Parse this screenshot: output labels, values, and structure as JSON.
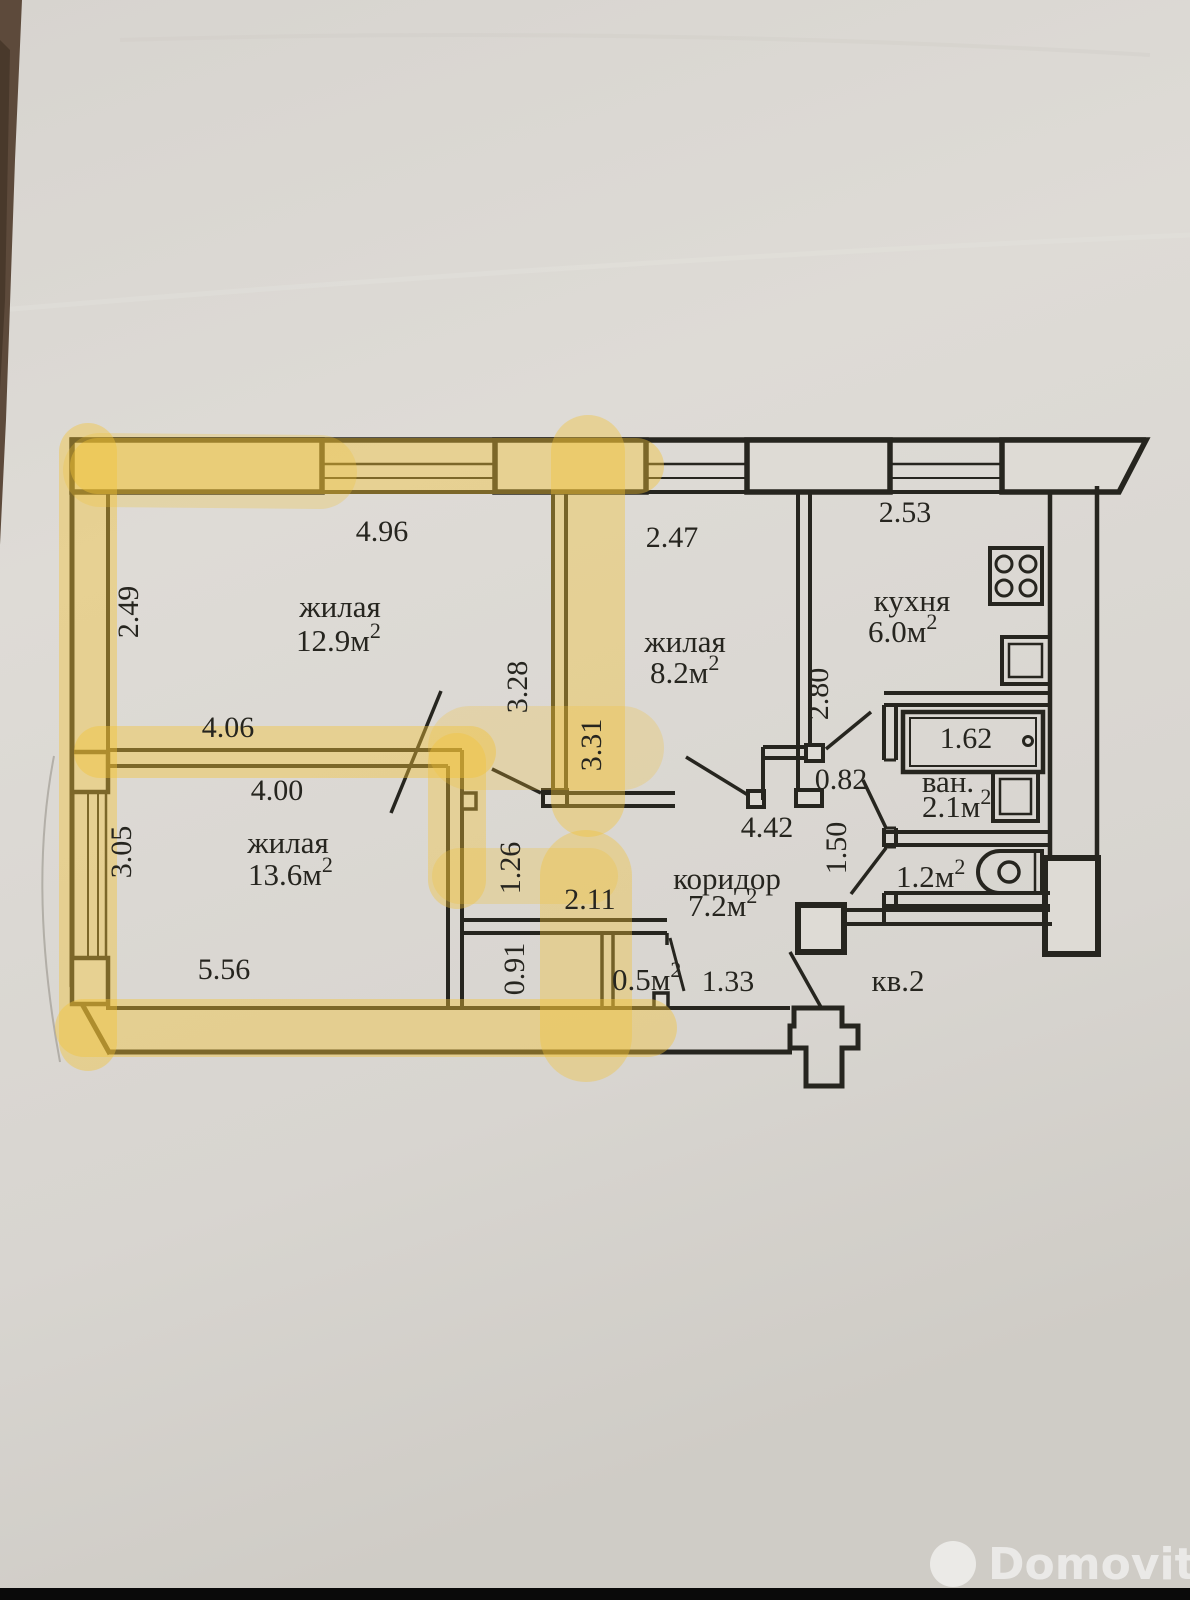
{
  "plan": {
    "room_labels": {
      "living1": {
        "name": "жилая",
        "area": "12.9м",
        "sup": "2"
      },
      "living2": {
        "name": "жилая",
        "area": "8.2м",
        "sup": "2"
      },
      "living3": {
        "name": "жилая",
        "area": "13.6м",
        "sup": "2"
      },
      "kitchen": {
        "name": "кухня",
        "area": "6.0м",
        "sup": "2"
      },
      "bathroom": {
        "name": "ван.",
        "area": "2.1м",
        "sup": "2"
      },
      "wc": {
        "area": "1.2м",
        "sup": "2"
      },
      "corridor": {
        "name": "коридор",
        "area": "7.2м",
        "sup": "2"
      },
      "closet": {
        "area": "0.5м",
        "sup": "2"
      },
      "unit": "кв.2"
    },
    "dimensions": {
      "d496": "4.96",
      "d247": "2.47",
      "d253": "2.53",
      "d249": "2.49",
      "d328": "3.28",
      "d331": "3.31",
      "d280": "2.80",
      "d406": "4.06",
      "d400": "4.00",
      "d162": "1.62",
      "d082": "0.82",
      "d442": "4.42",
      "d150": "1.50",
      "d305": "3.05",
      "d126": "1.26",
      "d211": "2.11",
      "d091": "0.91",
      "d556": "5.56",
      "d133": "1.33"
    }
  },
  "watermark": {
    "brand": "Domovita"
  },
  "colors": {
    "highlight": "#f2c336",
    "ink": "#26251f",
    "paper": "#dad7d2"
  }
}
